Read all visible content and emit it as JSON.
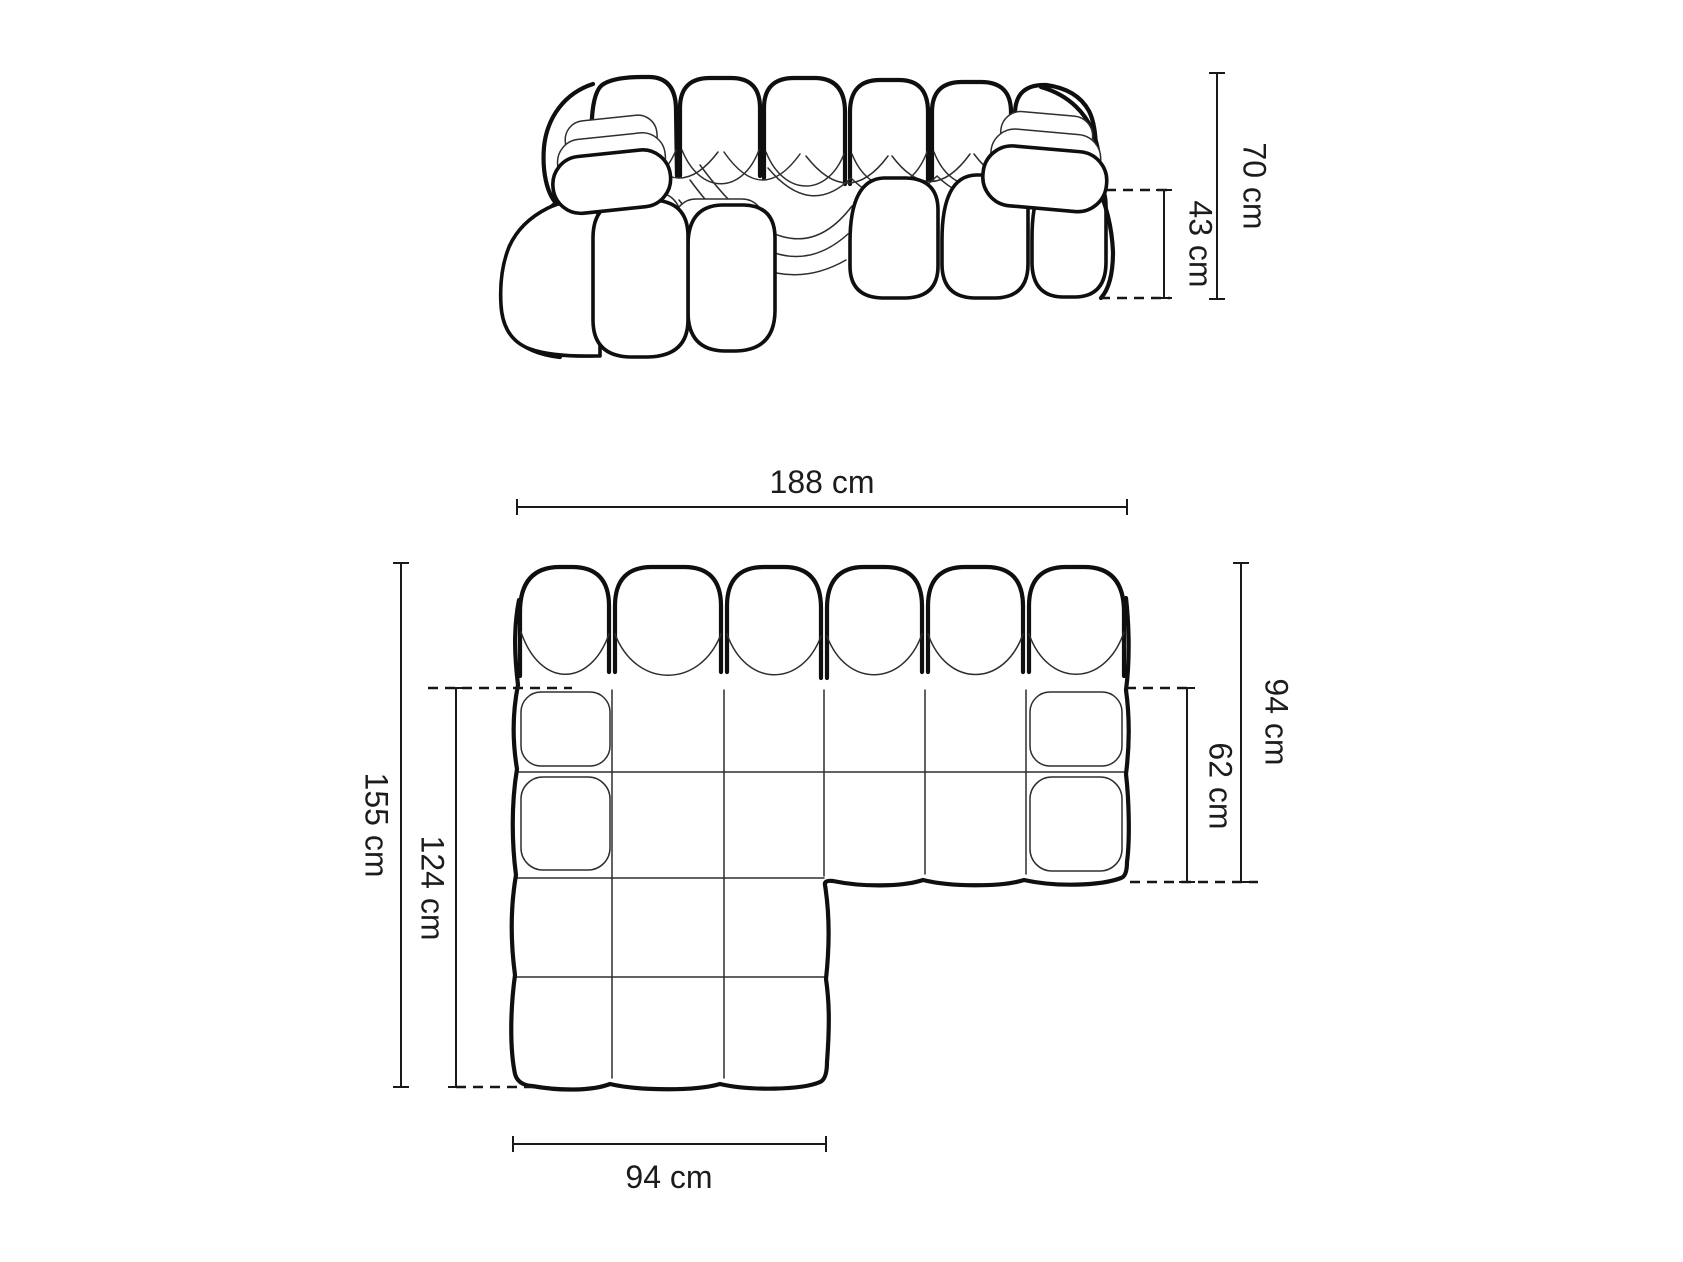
{
  "diagram": {
    "product": "modular-chaise-sofa-dimension-drawing",
    "colors": {
      "background": "#ffffff",
      "outline_bold": "#0f0f0f",
      "outline_thin": "#2e2e2e",
      "dimension_line": "#1a1a1a",
      "text": "#1c1c1c"
    },
    "front_view": {
      "dims": {
        "total_height": "70 cm",
        "seat_height": "43 cm"
      }
    },
    "top_view": {
      "dims": {
        "total_width": "188 cm",
        "total_depth": "155 cm",
        "chaise_depth": "124 cm",
        "right_depth": "94 cm",
        "right_seat_depth": "62 cm",
        "chaise_width": "94 cm"
      }
    }
  }
}
